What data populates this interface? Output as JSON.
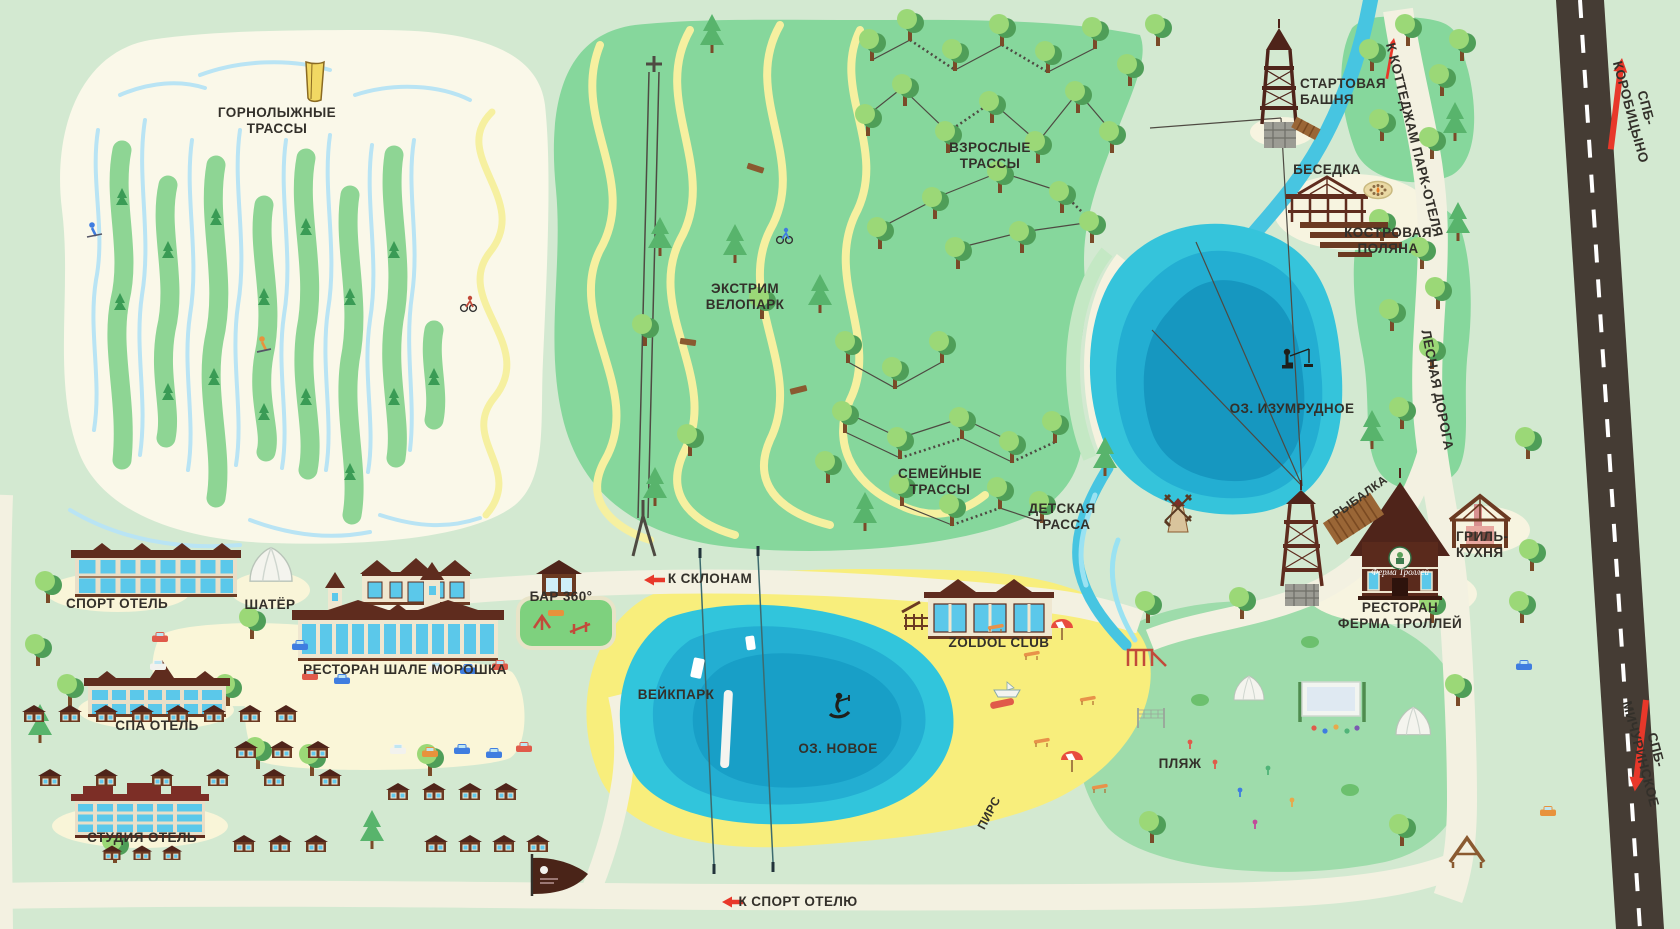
{
  "map": {
    "labels": {
      "ski_slopes": "ГОРНОЛЫЖНЫЕ\nТРАССЫ",
      "extreme_bike_park": "ЭКСТРИМ\nВЕЛОПАРК",
      "adult_trails": "ВЗРОСЛЫЕ\nТРАССЫ",
      "family_trails": "СЕМЕЙНЫЕ\nТРАССЫ",
      "kids_trail": "ДЕТСКАЯ\nТРАССА",
      "start_tower": "СТАРТОВАЯ\nБАШНЯ",
      "gazebo": "БЕСЕДКА",
      "campfire_glade": "КОСТРОВАЯ\nПОЛЯНА",
      "emerald_lake": "ОЗ. ИЗУМРУДНОЕ",
      "fishing": "РЫБАЛКА",
      "grill_kitchen": "ГРИЛЬ-\nКУХНЯ",
      "troll_farm_restaurant": "РЕСТОРАН\nФЕРМА ТРОЛЛЕЙ",
      "troll_farm_sign": "Ферма Троллей",
      "forest_road": "ЛЕСНАЯ ДОРОГА",
      "to_cottages": "К КОТТЕДЖАМ ПАРК-ОТЕЛЯ",
      "spb_korobitsyno": "СПБ-КОРОБИЦЫНО",
      "spb_michurinskoe": "СПБ-МИЧУРИНСКОЕ",
      "sport_hotel": "СПОРТ ОТЕЛЬ",
      "tent": "ШАТЁР",
      "bar_360": "БАР 360°",
      "to_slopes": "К СКЛОНАМ",
      "chalet_moroshka_restaurant": "РЕСТОРАН ШАЛЕ МОРОШКА",
      "spa_hotel": "СПА ОТЕЛЬ",
      "wake_park": "ВЕЙКПАРК",
      "new_lake": "ОЗ. НОВОЕ",
      "zoldol_club": "ZOLDOL CLUB",
      "pier": "ПИРС",
      "beach": "ПЛЯЖ",
      "studio_hotel": "СТУДИЯ ОТЕЛЬ",
      "to_sport_hotel": "К СПОРТ ОТЕЛЮ"
    },
    "colors": {
      "background": "#d3e9d1",
      "ski_area": "#faf8e9",
      "forest_green": "#86d79c",
      "lawn_green": "#9edcab",
      "slope_streak": "#8ed594",
      "ski_line_blue": "#b9e4f4",
      "trail_yellow": "#f6f0a0",
      "lake_outer": "#35c4db",
      "lake_mid": "#23aed2",
      "lake_deep": "#1697c0",
      "river": "#47c5e1",
      "beach_sand": "#f8ee7c",
      "pale_sand": "#faf6d8",
      "road": "#f3f1e1",
      "highway": "#453c34",
      "roof_brown": "#5f2c1e",
      "wall_cream": "#efe7d0",
      "window_blue": "#5bc8ea",
      "arrow_red": "#e8382a",
      "label_text": "#33302a"
    }
  }
}
